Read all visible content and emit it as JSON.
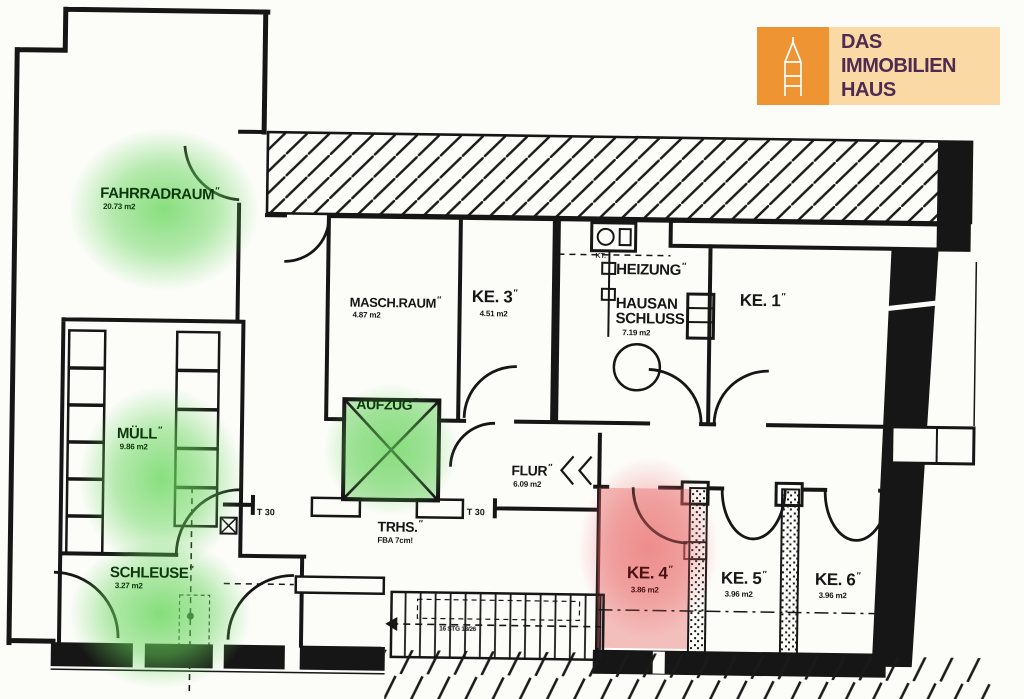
{
  "brand": {
    "name_line1": "DAS",
    "name_line2": "IMMOBILIEN",
    "name_line3": "HAUS",
    "icon": "church-tower-icon",
    "colors": {
      "orange": "#ef9433",
      "peach": "#fbd9a4",
      "text": "#4f2b52"
    }
  },
  "plan": {
    "rooms": {
      "fahrradraum": {
        "label": "FAHRRADRAUM",
        "area": "20.73 m2",
        "highlight": "#68d65c"
      },
      "muell": {
        "label": "MÜLL",
        "area": "9.86 m2",
        "highlight": "#68d65c"
      },
      "schleuse": {
        "label": "SCHLEUSE",
        "area": "3.27 m2",
        "highlight": "#68d65c"
      },
      "aufzug": {
        "label": "AUFZUG",
        "highlight": "#68d65c"
      },
      "masch_raum": {
        "label": "MASCH.RAUM",
        "area": "4.87 m2"
      },
      "ke3": {
        "label": "KE. 3",
        "area": "4.51 m2"
      },
      "heizung": {
        "label": "HEIZUNG"
      },
      "hausanschluss": {
        "label_line1": "HAUSAN",
        "label_line2": "SCHLUSS",
        "area": "7.19 m2"
      },
      "ke1": {
        "label": "KE. 1"
      },
      "flur": {
        "label": "FLUR",
        "area": "6.09 m2"
      },
      "trhs": {
        "label": "TRHS.",
        "note": "FBA 7cm!"
      },
      "ke4": {
        "label": "KE. 4",
        "area": "3.86 m2",
        "highlight": "#e96363"
      },
      "ke5": {
        "label": "KE. 5",
        "area": "3.96 m2"
      },
      "ke6": {
        "label": "KE. 6",
        "area": "3.96 m2"
      },
      "kt_symbol": {
        "label": "KT."
      }
    },
    "annotations": {
      "fire_door_left": "T 30",
      "fire_door_right": "T 30",
      "stair_note": "16 STG 18/26"
    },
    "marks": {
      "tick": "″"
    }
  }
}
